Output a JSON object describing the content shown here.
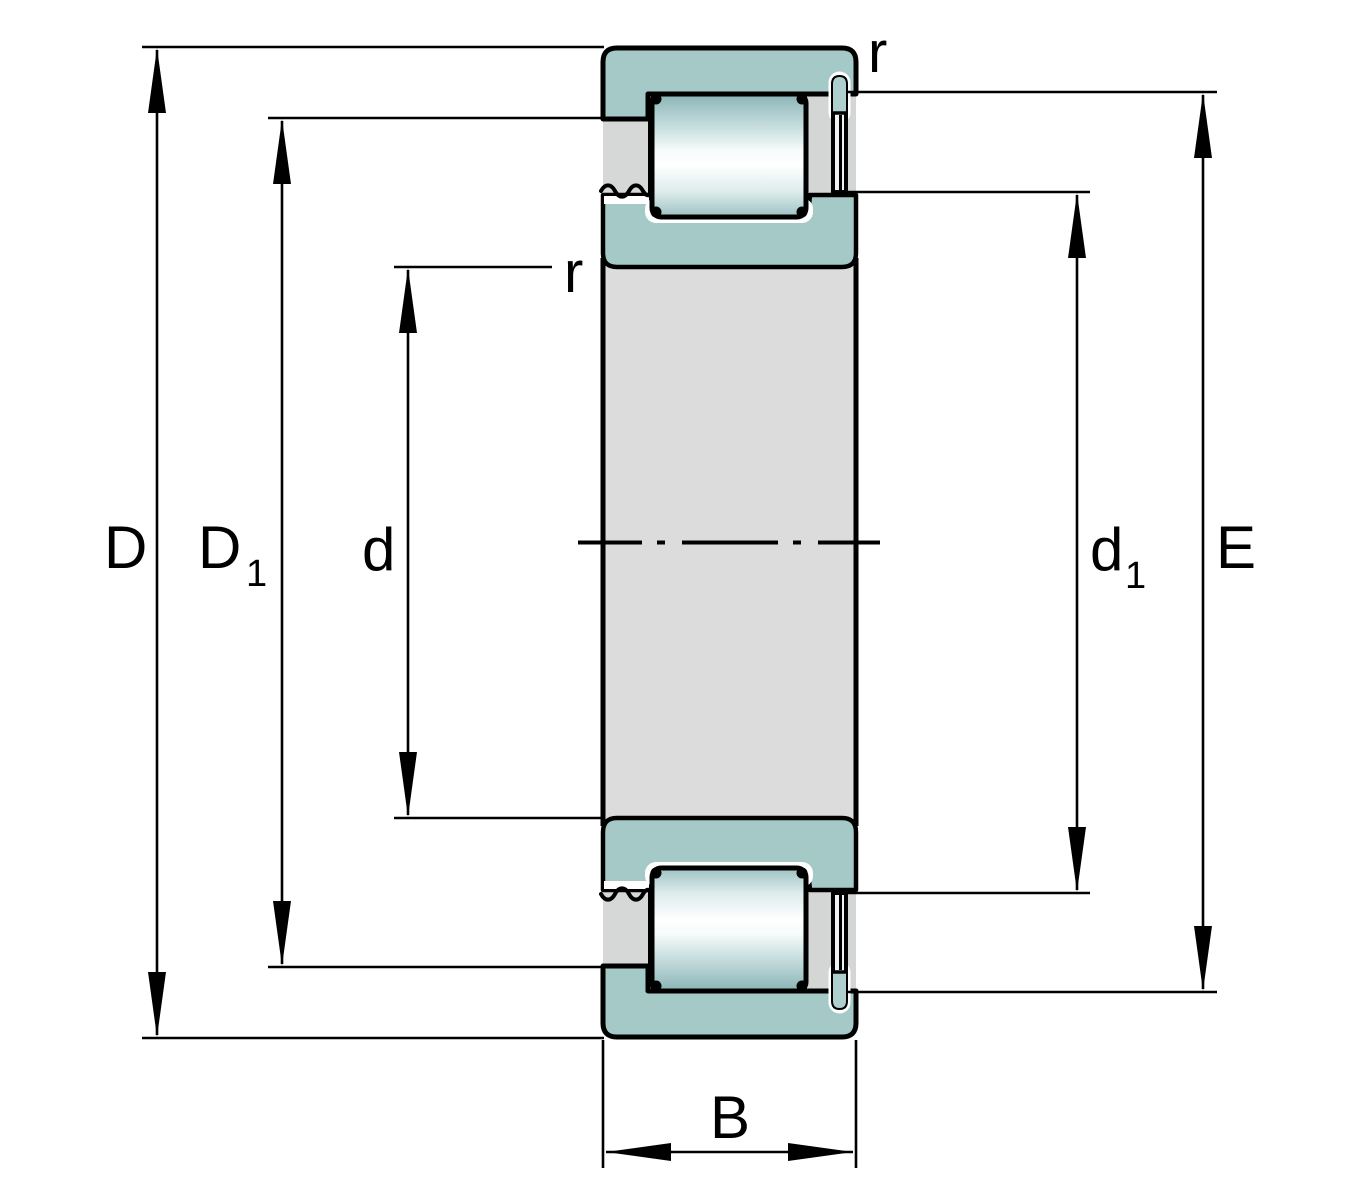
{
  "drawing": {
    "kind": "engineering-cross-section",
    "subject": "Single-row cylindrical roller bearing, half-section drawing with boundary dimensions",
    "colors": {
      "ring_teal": "#a4c9c7",
      "pin_cap_teal": "#aecfcd",
      "cage_gray": "#d6d7d7",
      "column_gray": "#d4d6d6",
      "bore_steel": "#dcdcdd",
      "pin_stem": "#eef4f4",
      "outline_black": "#000000",
      "highlight_white": "#ffffff",
      "background": "#ffffff"
    },
    "dim_labels": {
      "D": {
        "text": "D",
        "sub": ""
      },
      "D1": {
        "text": "D",
        "sub": "1"
      },
      "d": {
        "text": "d",
        "sub": ""
      },
      "d1": {
        "text": "d",
        "sub": "1"
      },
      "E": {
        "text": "E",
        "sub": ""
      },
      "B": {
        "text": "B",
        "sub": ""
      },
      "r_outer": {
        "text": "r"
      },
      "r_bore": {
        "text": "r"
      }
    }
  }
}
